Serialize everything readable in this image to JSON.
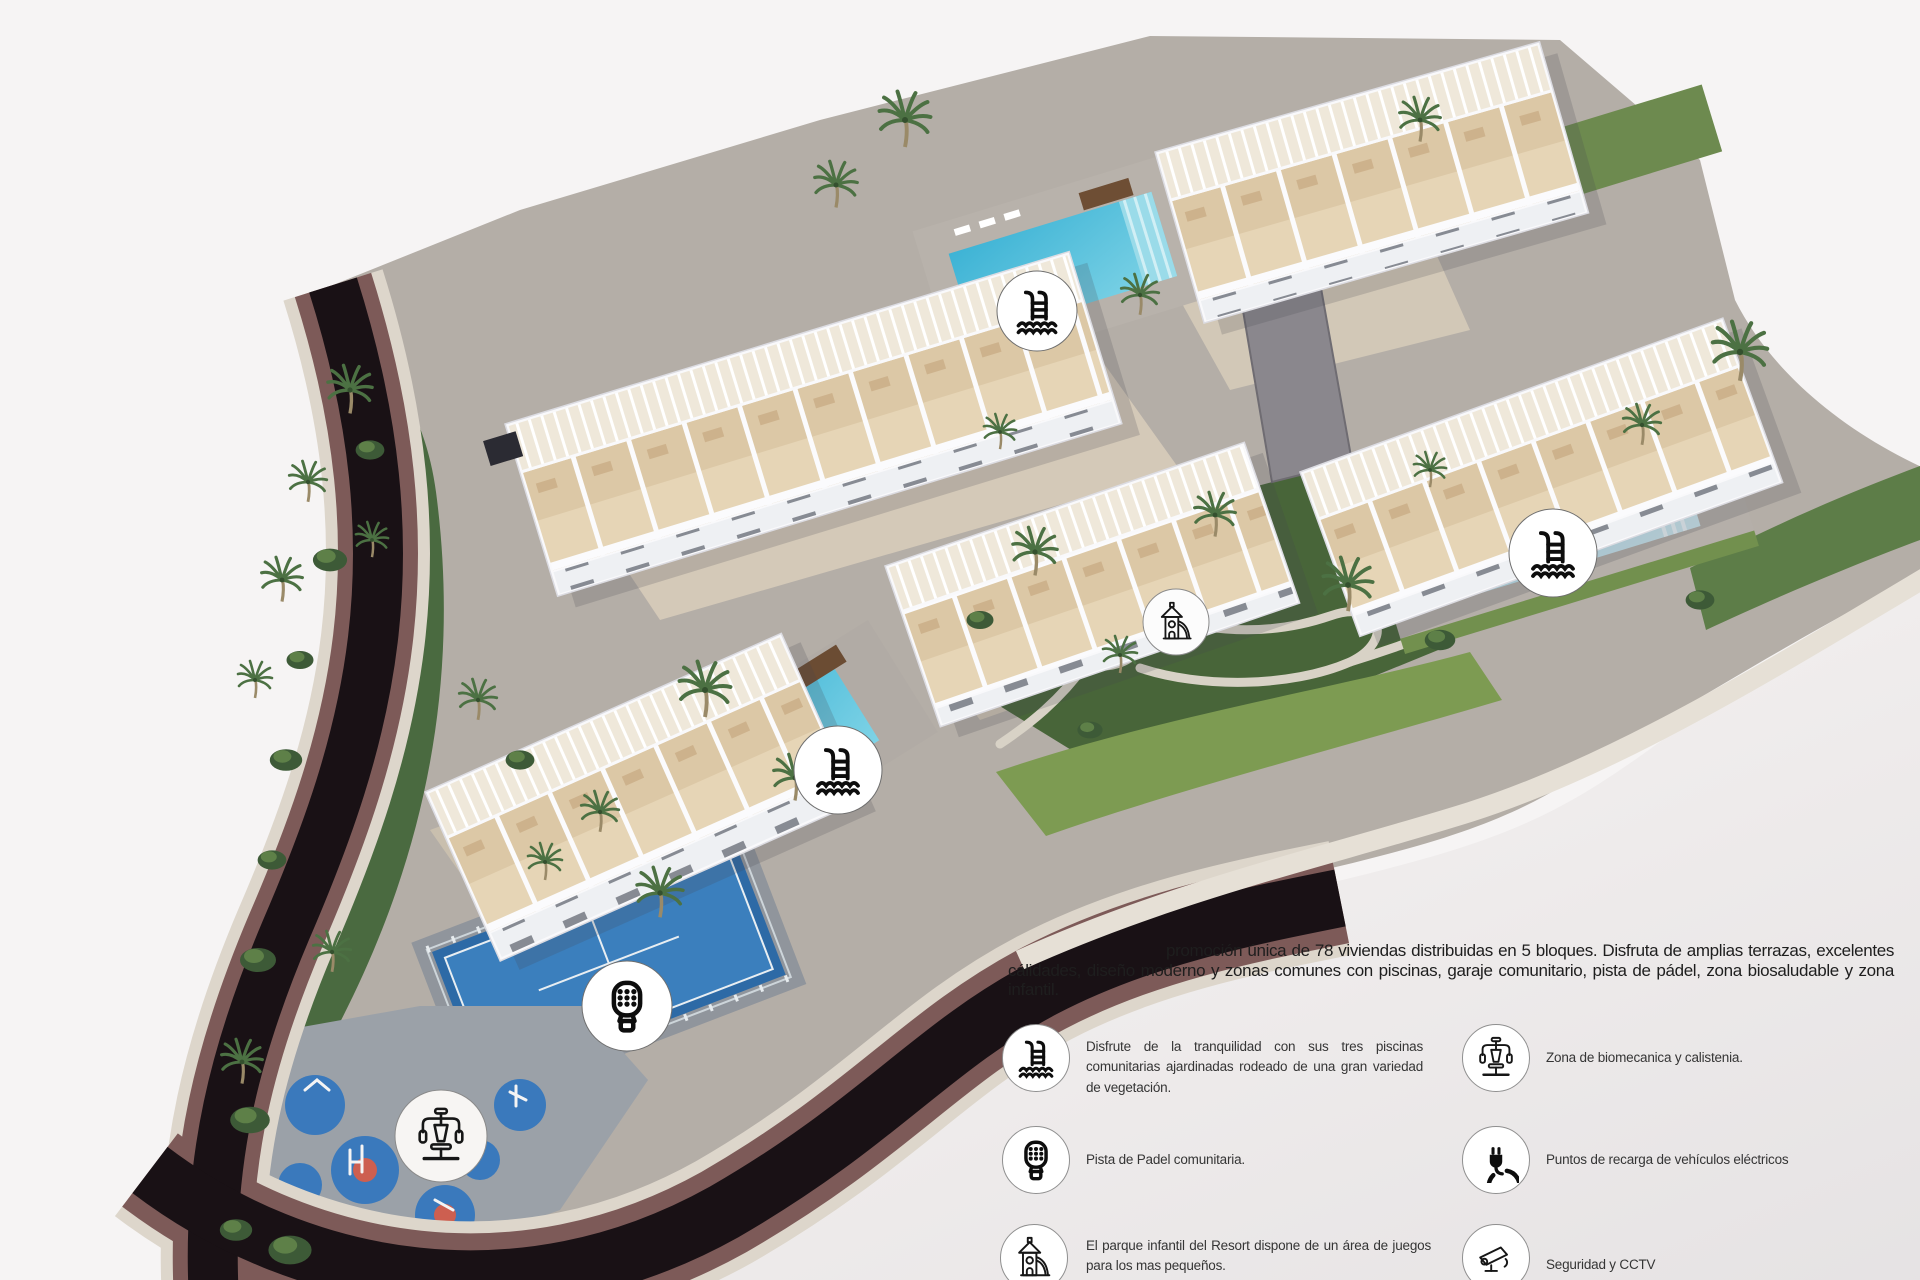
{
  "page": {
    "kind": "resort-masterplan-render",
    "colors": {
      "background": "#f6f4f4",
      "background_shade": "#e7e4e5",
      "road_dark": "#191115",
      "road_wall_brown": "#7d5a58",
      "stone_edge": "#ded7cc",
      "pool_water": "#45bddb",
      "pool_water_light": "#a5dcea",
      "grass_dark": "#486539",
      "grass_light": "#7d9b52",
      "padel_blue": "#2d6aa6",
      "playground_blue": "#3a79bc",
      "terrace_beige": "#e4d3b4",
      "building_white": "#f9f9fb"
    }
  },
  "description": {
    "text": "promoción única de 78 viviendas distribuidas en 5 bloques. Disfruta de amplias terrazas, excelentes cálidades, diseño moderno y zonas comunes con piscinas, garaje comunitario, pista de pádel, zona biosaludable y zona infantil."
  },
  "legend": {
    "items": [
      {
        "icon": "pool-icon",
        "text": "Disfrute de la tranquilidad con sus tres piscinas comunitarias ajardinadas rodeado de una gran variedad de vegetación."
      },
      {
        "icon": "padel-icon",
        "text": "Pista de Padel comunitaria."
      },
      {
        "icon": "playground-icon",
        "text": "El parque infantil del Resort dispone de un área de juegos para los mas pequeños."
      },
      {
        "icon": "gym-icon",
        "text": "Zona de biomecanica y calistenia."
      },
      {
        "icon": "plug-icon",
        "text": "Puntos de recarga de vehículos eléctricos"
      },
      {
        "icon": "cctv-icon",
        "text": "Seguridad y CCTV"
      }
    ]
  },
  "map": {
    "markers": [
      {
        "icon": "pool-icon"
      },
      {
        "icon": "pool-icon"
      },
      {
        "icon": "pool-icon"
      },
      {
        "icon": "playground-icon"
      },
      {
        "icon": "padel-icon"
      },
      {
        "icon": "gym-icon"
      }
    ]
  }
}
